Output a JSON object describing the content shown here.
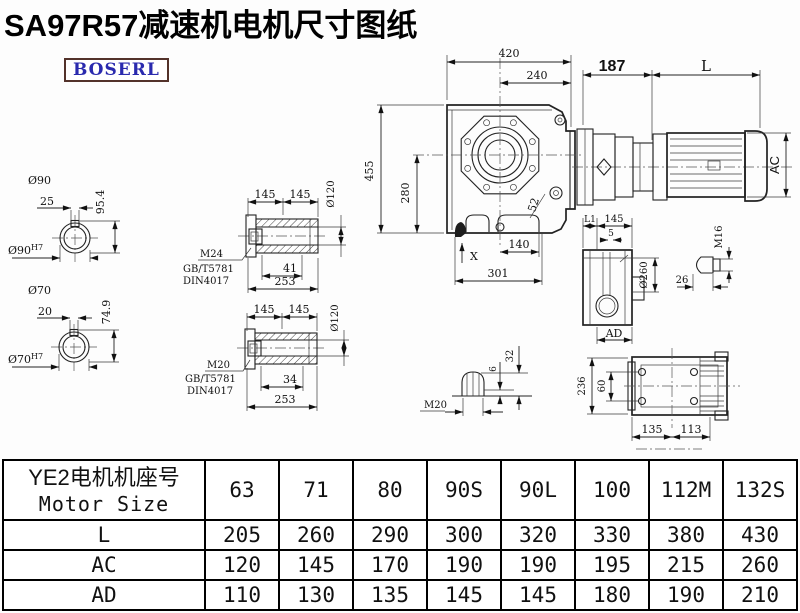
{
  "title": "SA97R57减速机电机尺寸图纸",
  "brand": "BOSERL",
  "drawing": {
    "shaft90": {
      "title": "Ø90",
      "key_width": "25",
      "height": "95.4",
      "bore": "Ø90",
      "bore_tol": "H7"
    },
    "shaft70": {
      "title": "Ø70",
      "key_width": "20",
      "height": "74.9",
      "bore": "Ø70",
      "bore_tol": "H7"
    },
    "hollow_top": {
      "len_a": "145",
      "len_b": "145",
      "dia": "Ø120",
      "thread": "M24",
      "std1": "GB/T5781",
      "std2": "DIN4017",
      "depth": "41",
      "total": "253"
    },
    "hollow_bottom": {
      "len_a": "145",
      "len_b": "145",
      "dia": "Ø120",
      "thread": "M20",
      "std1": "GB/T5781",
      "std2": "DIN4017",
      "depth": "34",
      "total": "253"
    },
    "front": {
      "width": "420",
      "width_center": "240",
      "height": "455",
      "height_center": "280",
      "plug": "52",
      "x_mark": "X",
      "foot_a": "140",
      "foot_b": "301"
    },
    "motor": {
      "adapter": "187",
      "length": "L",
      "ac": "AC"
    },
    "side": {
      "l1": "L1",
      "width": "145",
      "offset": "5",
      "dia": "Ø260",
      "ad": "AD",
      "plug_thread": "M16",
      "plug_len": "26"
    },
    "breather": {
      "height": "32",
      "collar": "6",
      "thread": "M20"
    },
    "top_view": {
      "height": "236",
      "hole_pitch": "60",
      "base_a": "135",
      "base_b": "113"
    }
  },
  "table": {
    "header": {
      "row_label_cn": "YE2电机机座号",
      "row_label_en": "Motor Size",
      "sizes": [
        "63",
        "71",
        "80",
        "90S",
        "90L",
        "100",
        "112M",
        "132S"
      ]
    },
    "rows": [
      {
        "label": "L",
        "values": [
          "205",
          "260",
          "290",
          "300",
          "320",
          "330",
          "380",
          "430"
        ]
      },
      {
        "label": "AC",
        "values": [
          "120",
          "145",
          "170",
          "190",
          "190",
          "195",
          "215",
          "260"
        ]
      },
      {
        "label": "AD",
        "values": [
          "110",
          "130",
          "135",
          "145",
          "145",
          "180",
          "190",
          "210"
        ]
      }
    ]
  }
}
